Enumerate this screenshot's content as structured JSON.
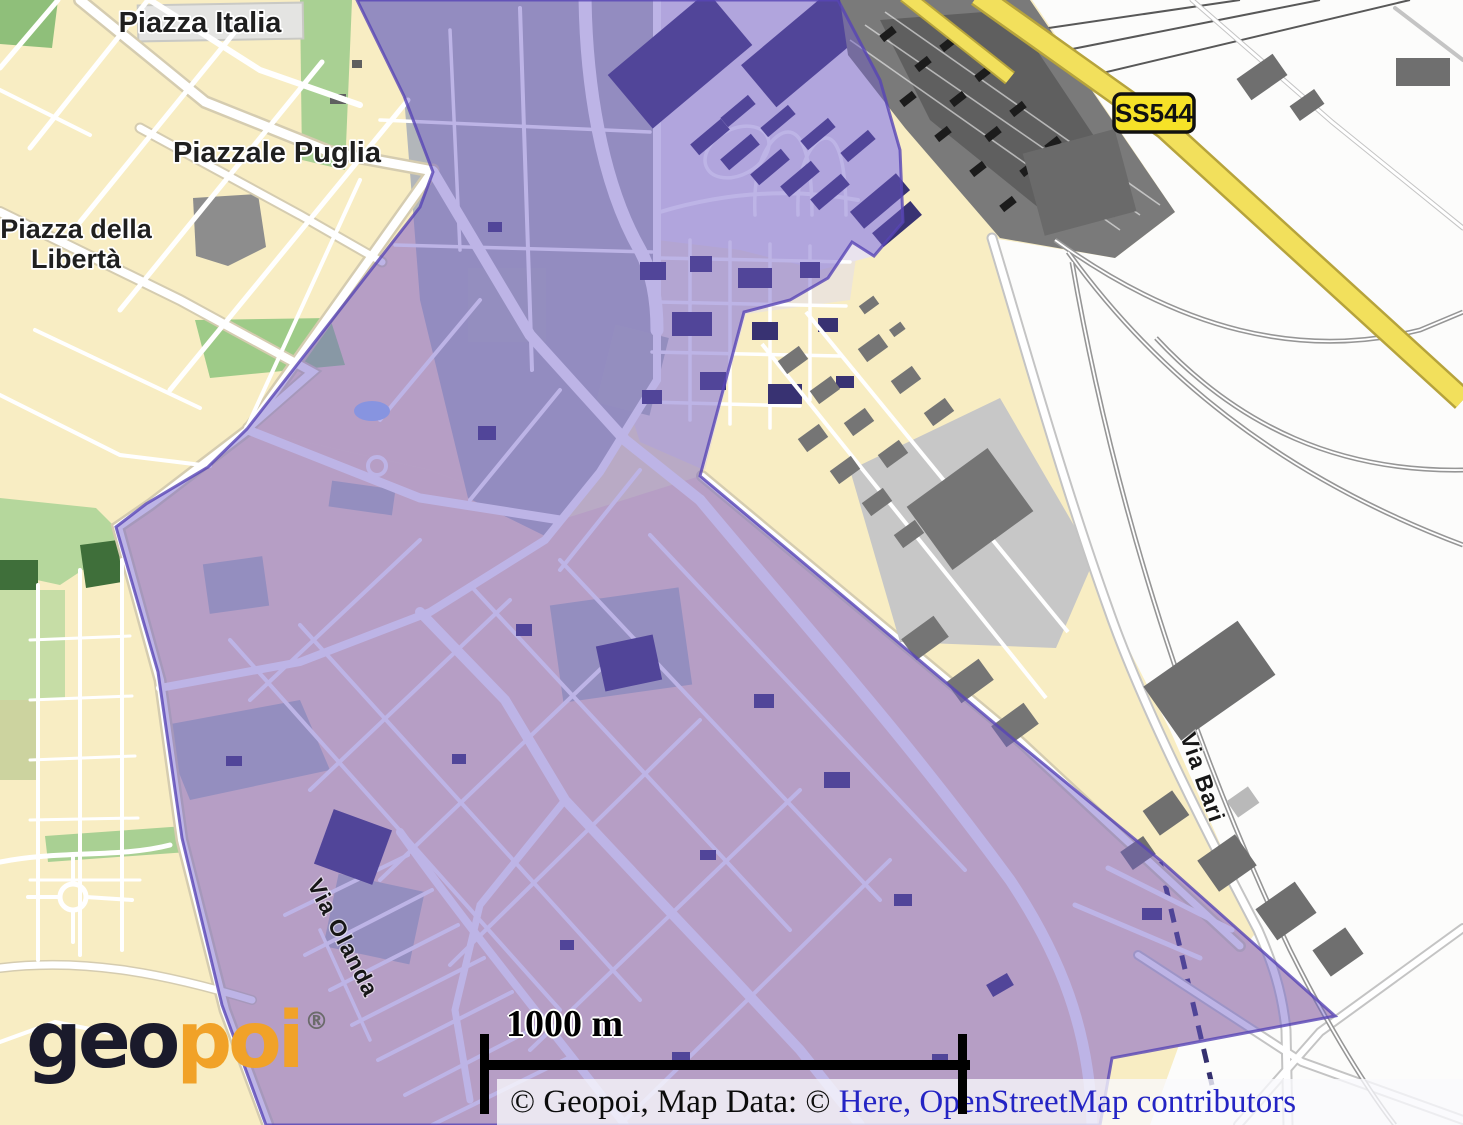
{
  "map": {
    "description": "Street map with highlighted municipal district overlay",
    "labels": {
      "piazza_italia": "Piazza Italia",
      "piazzale_puglia": "Piazzale Puglia",
      "piazza_della_liberta_line1": "Piazza della",
      "piazza_della_liberta_line2": "Libertà",
      "via_olanda": "Via Olanda",
      "via_bari": "Via Bari"
    },
    "road_shield": {
      "label": "SS544",
      "bg_color": "#f6e227",
      "border_color": "#111111"
    },
    "overlay": {
      "fill": "#6f5cc9",
      "opacity": "0.46",
      "border": "#5745b5"
    },
    "palette": {
      "land_cream": "#f8edc3",
      "land_white": "#fcfcfb",
      "park_green": "#a9d093",
      "railyard_gray": "#7a7a7a",
      "highway_yellow": "#f2e05c",
      "building_gray": "#6f6f6f",
      "overlay_building_purple": "#383272",
      "water_blue": "#9cc4f4"
    }
  },
  "logo": {
    "text_dark": "geo",
    "text_orange": "poi",
    "registered_mark": "®",
    "dark_color": "#1a1a2b",
    "orange_color": "#f1a228"
  },
  "scale_bar": {
    "label": "1000 m"
  },
  "attribution": {
    "prefix": "© Geopoi, Map Data: © ",
    "link_here": "Here",
    "separator": ", ",
    "link_osm": "OpenStreetMap",
    "suffix": " contributors",
    "link_color": "#2424c4"
  }
}
